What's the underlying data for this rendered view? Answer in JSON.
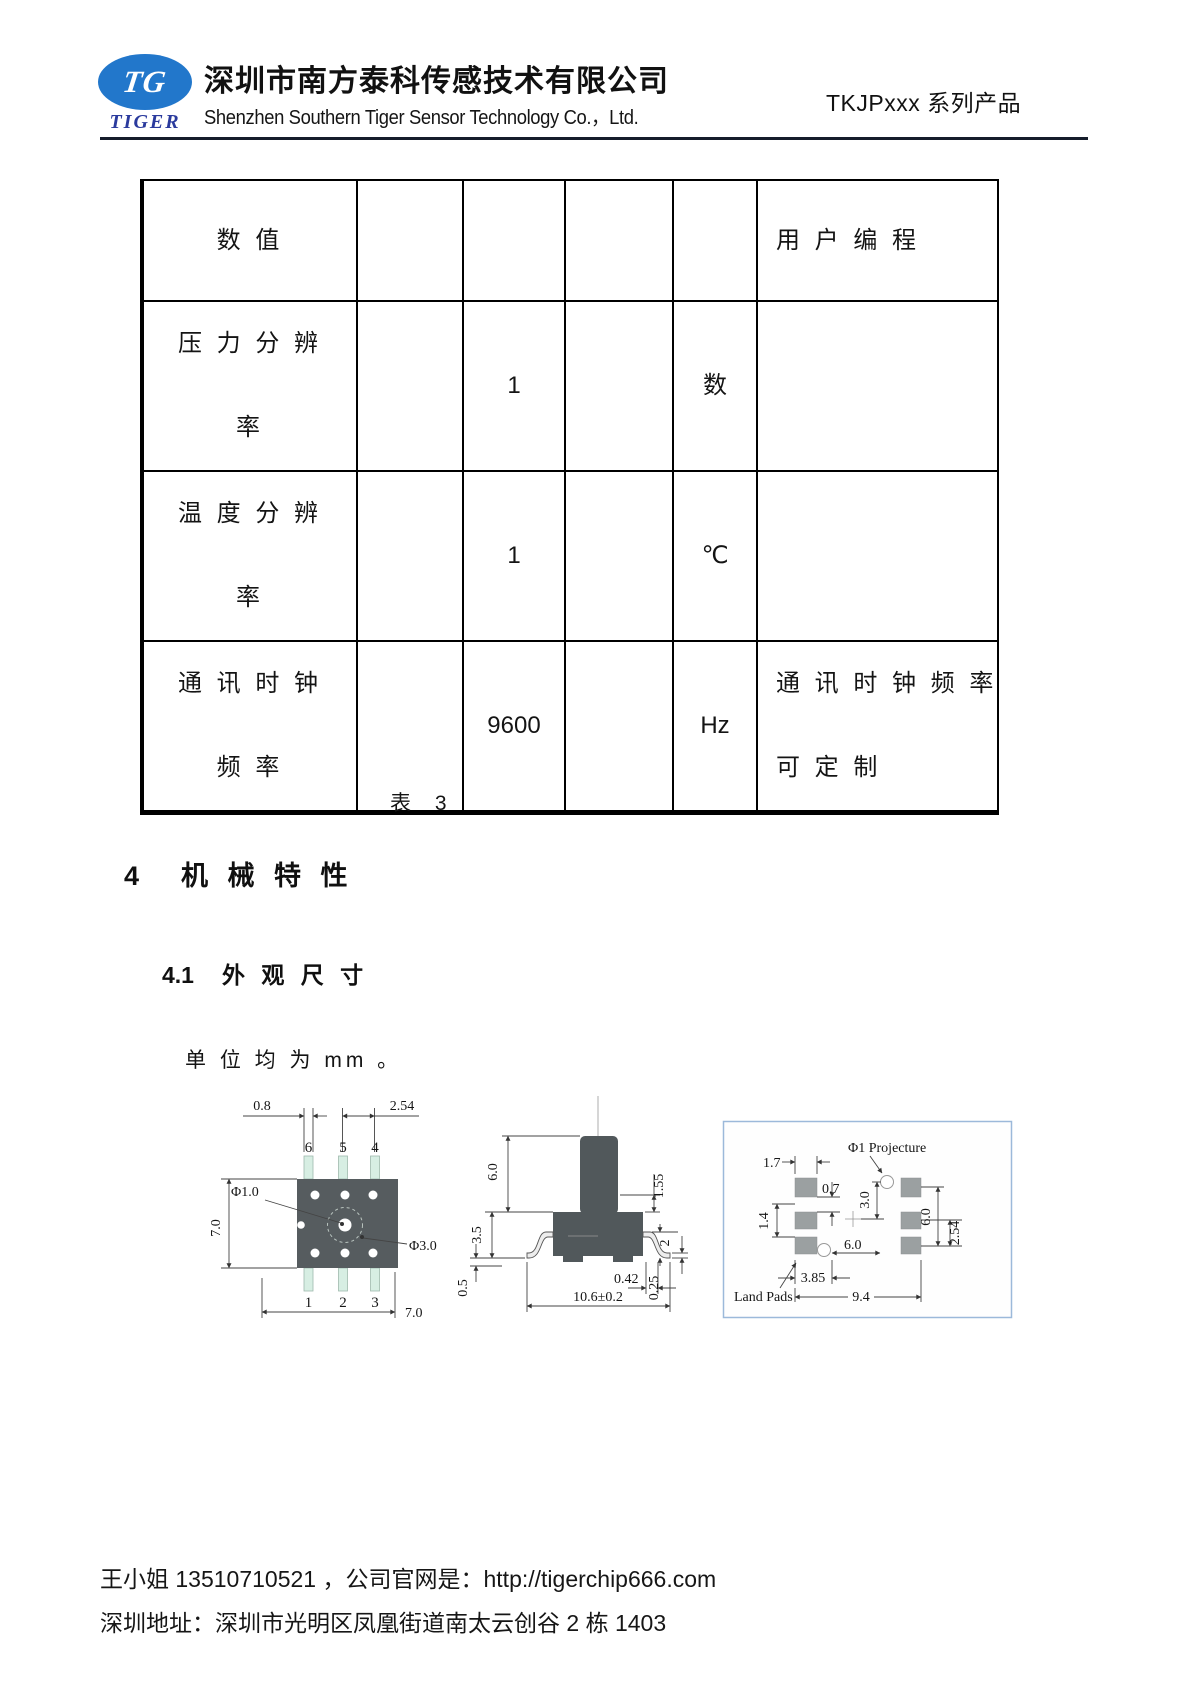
{
  "header": {
    "logo_monogram": "TG",
    "logo_wordmark": "TIGER",
    "company_name_cn": "深圳市南方泰科传感技术有限公司",
    "company_name_en": "Shenzhen Southern Tiger Sensor Technology Co.，Ltd.",
    "product_series": "TKJPxxx 系列产品"
  },
  "table": {
    "caption": "表 3",
    "rows": [
      {
        "name": "数 值",
        "value": "",
        "unit": "",
        "note": "用 户 编 程"
      },
      {
        "name": "压 力 分 辨\n率",
        "value": "1",
        "unit": "数",
        "note": ""
      },
      {
        "name": "温 度 分 辨\n率",
        "value": "1",
        "unit": "℃",
        "note": ""
      },
      {
        "name": "通 讯 时 钟\n频 率",
        "value": "9600",
        "unit": "Hz",
        "note": "通 讯 时 钟 频 率\n可 定 制"
      }
    ]
  },
  "sections": {
    "s4_num": "4",
    "s4_title": "机 械 特 性",
    "s41_num": "4.1",
    "s41_title": "外 观 尺 寸",
    "unit_note": "单 位 均 为 mm 。"
  },
  "figures": {
    "top_view": {
      "pin_top": [
        "6",
        "5",
        "4"
      ],
      "pin_bottom": [
        "1",
        "2",
        "3"
      ],
      "dim_08": "0.8",
      "dim_254": "2.54",
      "dim_phi1": "Φ1.0",
      "dim_70_left": "7.0",
      "dim_phi3": "Φ3.0",
      "dim_70_bottom": "7.0"
    },
    "side_view": {
      "dim_60": "6.0",
      "dim_35": "3.5",
      "dim_05": "0.5",
      "dim_155": "1.55",
      "dim_2": "2",
      "dim_025": "0.25",
      "dim_042": "0.42",
      "dim_106": "10.6±0.2"
    },
    "land_pads": {
      "title": "Φ1 Projecture",
      "label": "Land Pads",
      "dim_17": "1.7",
      "dim_07": "0.7",
      "dim_14": "1.4",
      "dim_30": "3.0",
      "dim_60_h": "6.0",
      "dim_385": "3.85",
      "dim_94": "9.4",
      "dim_60_v": "6.0",
      "dim_254": "2.54"
    }
  },
  "footer": {
    "contact": "王小姐 13510710521 ，公司官网是：",
    "url": "http://tigerchip666.com",
    "address": "深圳地址：深圳市光明区凤凰街道南太云创谷 2 栋 1403"
  }
}
